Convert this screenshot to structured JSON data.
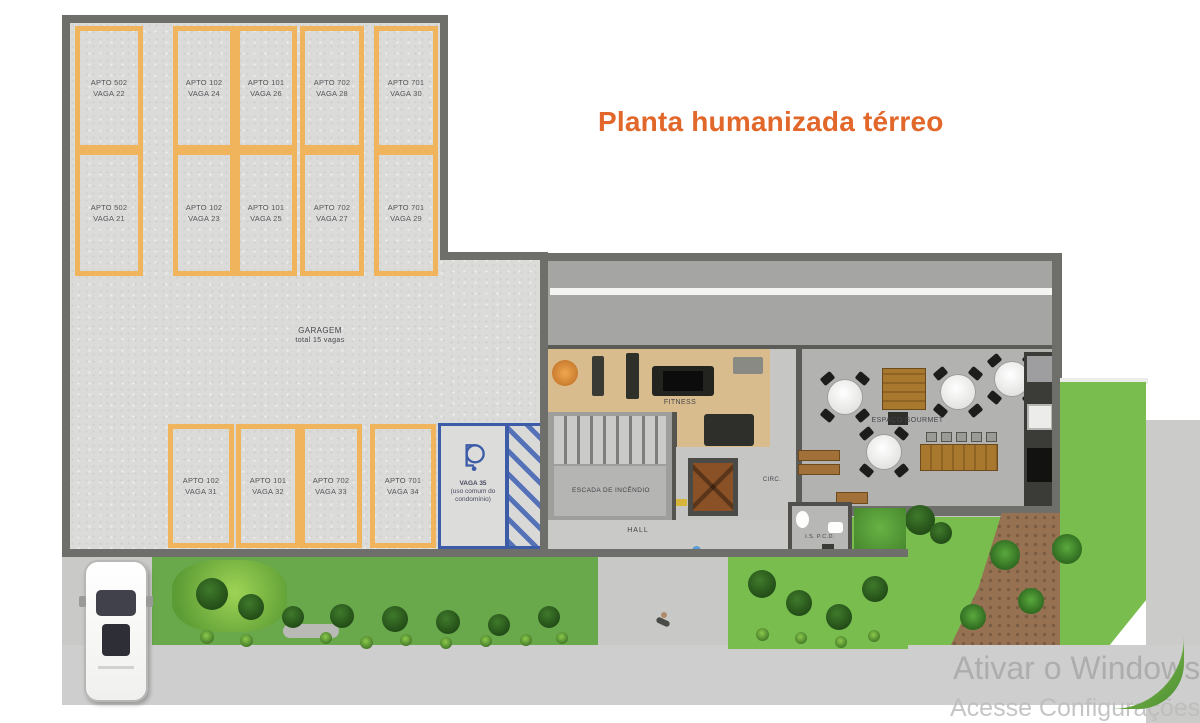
{
  "title": {
    "text": "Planta humanizada térreo",
    "color": "#e2672b"
  },
  "garage": {
    "label": "GARAGEM",
    "sublabel": "total 15 vagas",
    "row_top": [
      {
        "apto": "APTO 502",
        "vaga": "VAGA 22"
      },
      {
        "apto": "APTO 102",
        "vaga": "VAGA 24"
      },
      {
        "apto": "APTO 101",
        "vaga": "VAGA 26"
      },
      {
        "apto": "APTO 702",
        "vaga": "VAGA 28"
      },
      {
        "apto": "APTO 701",
        "vaga": "VAGA 30"
      }
    ],
    "row_middle": [
      {
        "apto": "APTO 502",
        "vaga": "VAGA 21"
      },
      {
        "apto": "APTO 102",
        "vaga": "VAGA 23"
      },
      {
        "apto": "APTO 101",
        "vaga": "VAGA 25"
      },
      {
        "apto": "APTO 702",
        "vaga": "VAGA 27"
      },
      {
        "apto": "APTO 701",
        "vaga": "VAGA 29"
      }
    ],
    "row_bottom": [
      {
        "apto": "APTO 102",
        "vaga": "VAGA 31"
      },
      {
        "apto": "APTO 101",
        "vaga": "VAGA 32"
      },
      {
        "apto": "APTO 702",
        "vaga": "VAGA 33"
      },
      {
        "apto": "APTO 701",
        "vaga": "VAGA 34"
      }
    ],
    "accessible_spot": {
      "title": "VAGA 35",
      "note_line1": "(uso comum do",
      "note_line2": "condomínio)",
      "icon": "wheelchair-icon"
    }
  },
  "building": {
    "fitness_label": "FITNESS",
    "stairs_label": "ESCADA DE INCÊNDIO",
    "hall_label": "HALL",
    "circulation_label": "CIRC.",
    "gourmet_label": "ESPAÇO GOURMET",
    "accessible_wc_label": "I.S. P.C.D."
  },
  "watermark": {
    "line1": "Ativar o Windows",
    "line2": "Acesse Configurações"
  },
  "colors": {
    "title_orange": "#e2672b",
    "parking_line_orange": "#f0b45c",
    "accessible_blue": "#3c5ca8",
    "lawn_green": "#79bd4f",
    "wood_floor": "#d9bc8e"
  }
}
